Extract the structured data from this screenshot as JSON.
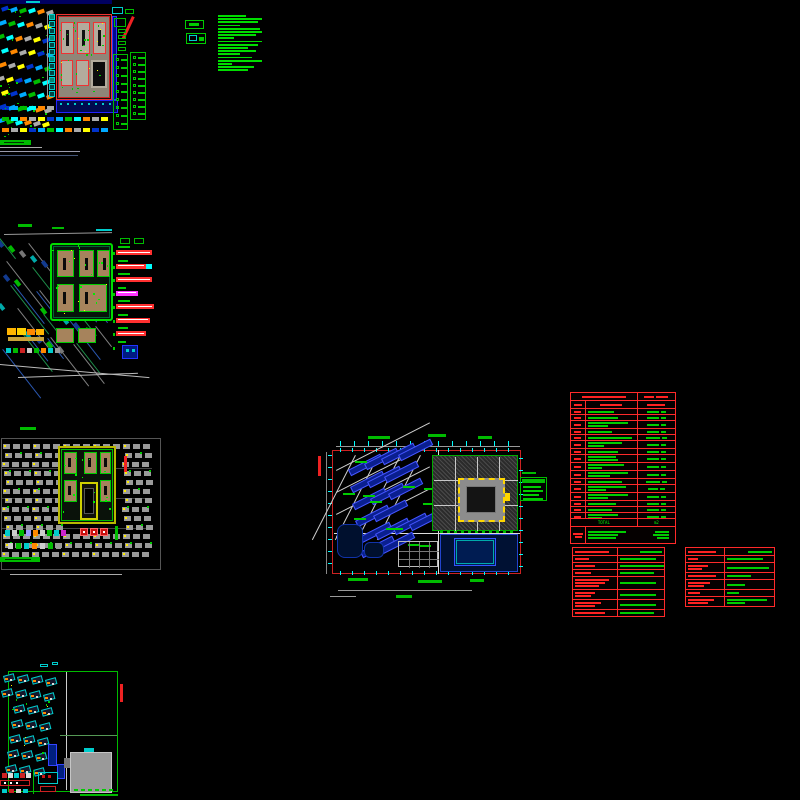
{
  "window": {
    "type": "cad-model-space-overview",
    "background": "#000000"
  },
  "palette": {
    "red": "#ff2222",
    "dark_red": "#cc1111",
    "green": "#00cc00",
    "bright_green": "#00ff00",
    "cyan": "#00ffff",
    "blue": "#2233ff",
    "navy": "#001a66",
    "gray": "#9a9a9a",
    "tan": "#a6835c",
    "yellow": "#ffd700",
    "orange": "#ff8800",
    "magenta": "#ff33ff",
    "white": "#dddddd"
  },
  "notes_block": {
    "lines": [
      28,
      44,
      40,
      22,
      42,
      44,
      38,
      16,
      44,
      40,
      30,
      38,
      22,
      34,
      44,
      14,
      36,
      30
    ]
  },
  "area_table": {
    "columns": {
      "code_w": 14,
      "desc_w": 53,
      "value_w": 39
    },
    "title_w": 44,
    "title_right": [
      10,
      12
    ],
    "header": [
      8,
      22,
      18
    ],
    "rows": [
      {
        "c": 7,
        "d": [
          26
        ],
        "v": 12
      },
      {
        "c": 7,
        "d": [
          30
        ],
        "v": 12
      },
      {
        "c": 7,
        "d": [
          40,
          20
        ],
        "v": 12
      },
      {
        "c": 7,
        "d": [
          24
        ],
        "v": 12
      },
      {
        "c": 7,
        "d": [
          44
        ],
        "v": 14
      },
      {
        "c": 7,
        "d": [
          34,
          16
        ],
        "v": 12
      },
      {
        "c": 7,
        "d": [
          30
        ],
        "v": 12
      },
      {
        "c": 7,
        "d": [
          28,
          30
        ],
        "v": 12
      },
      {
        "c": 7,
        "d": [
          36,
          14
        ],
        "v": 12
      },
      {
        "c": 7,
        "d": [
          40,
          22
        ],
        "v": 12
      },
      {
        "c": 7,
        "d": [
          34
        ],
        "v": 14
      },
      {
        "c": 7,
        "d": [
          38,
          18
        ],
        "v": 10
      },
      {
        "c": 7,
        "d": [
          40,
          20
        ],
        "v": 12
      },
      {
        "c": 7,
        "d": [
          28
        ],
        "v": 12
      },
      {
        "c": 7,
        "d": [
          24
        ],
        "v": 12
      },
      {
        "c": 7,
        "d": [
          30,
          14
        ],
        "v": 12
      },
      {
        "c": 7,
        "d": [
          26
        ],
        "v": 12
      },
      {
        "c": 7,
        "d": [
          22
        ],
        "v": 12
      },
      {
        "c": 7,
        "d": [
          44
        ],
        "v": 12
      }
    ],
    "total_label": "TOTAL",
    "unit_label": "m2",
    "total_code_w": 10,
    "total_rows": [
      {
        "d": 38,
        "v": 14
      },
      {
        "d": 30,
        "v": 16
      },
      {
        "d": 28,
        "v": 12
      }
    ]
  },
  "spec_table_left": {
    "header_left_w": 34,
    "header_right_w": 22,
    "rows": [
      {
        "l": [
          14
        ],
        "r": [
          36
        ]
      },
      {
        "l": [
          20
        ],
        "r": [
          44
        ]
      },
      {
        "l": [
          16
        ],
        "r": [
          34
        ]
      },
      {
        "l": [
          34,
          30,
          24
        ],
        "r": [
          36
        ]
      },
      {
        "l": [
          20,
          16
        ],
        "r": [
          36
        ]
      },
      {
        "l": [
          26,
          20
        ],
        "r": [
          36
        ]
      },
      {
        "l": [
          30
        ],
        "r": [
          34
        ]
      }
    ]
  },
  "spec_table_right": {
    "header_left_w": 28,
    "header_right_w": 24,
    "rows": [
      {
        "l": [
          10
        ],
        "r": [
          36
        ]
      },
      {
        "l": [
          20,
          14
        ],
        "r": [
          42
        ]
      },
      {
        "l": [
          28
        ],
        "r": [
          24
        ]
      },
      {
        "l": [
          22,
          16
        ],
        "r": [
          18
        ]
      },
      {
        "l": [
          12
        ],
        "r": [
          12
        ]
      },
      {
        "l": [
          26,
          20
        ],
        "r": [
          40,
          18
        ]
      }
    ]
  },
  "legend_top_left_1": {
    "rows": 9
  },
  "legend_top_left_2": {
    "rows": 9
  },
  "legend_center": {
    "bar_widths": [
      18,
      20,
      16,
      20
    ]
  },
  "callouts": {
    "items": [
      {
        "label_w": 12,
        "bar_w": 36,
        "color": "#ff3030"
      },
      {
        "label_w": 10,
        "bar_w": 30,
        "color": "#ff3030",
        "tail": "#00ffff"
      },
      {
        "label_w": 12,
        "bar_w": 36,
        "color": "#ff3030"
      },
      {
        "label_w": 8,
        "bar_w": 22,
        "color": "#ff33ff"
      },
      {
        "label_w": 12,
        "bar_w": 38,
        "color": "#ff3030"
      },
      {
        "label_w": 10,
        "bar_w": 34,
        "color": "#ff3030"
      },
      {
        "label_w": 10,
        "bar_w": 30,
        "color": "#ff3030"
      },
      {
        "label_w": 8,
        "bar_w": 0,
        "color": "#2233ff",
        "box": true
      }
    ]
  }
}
